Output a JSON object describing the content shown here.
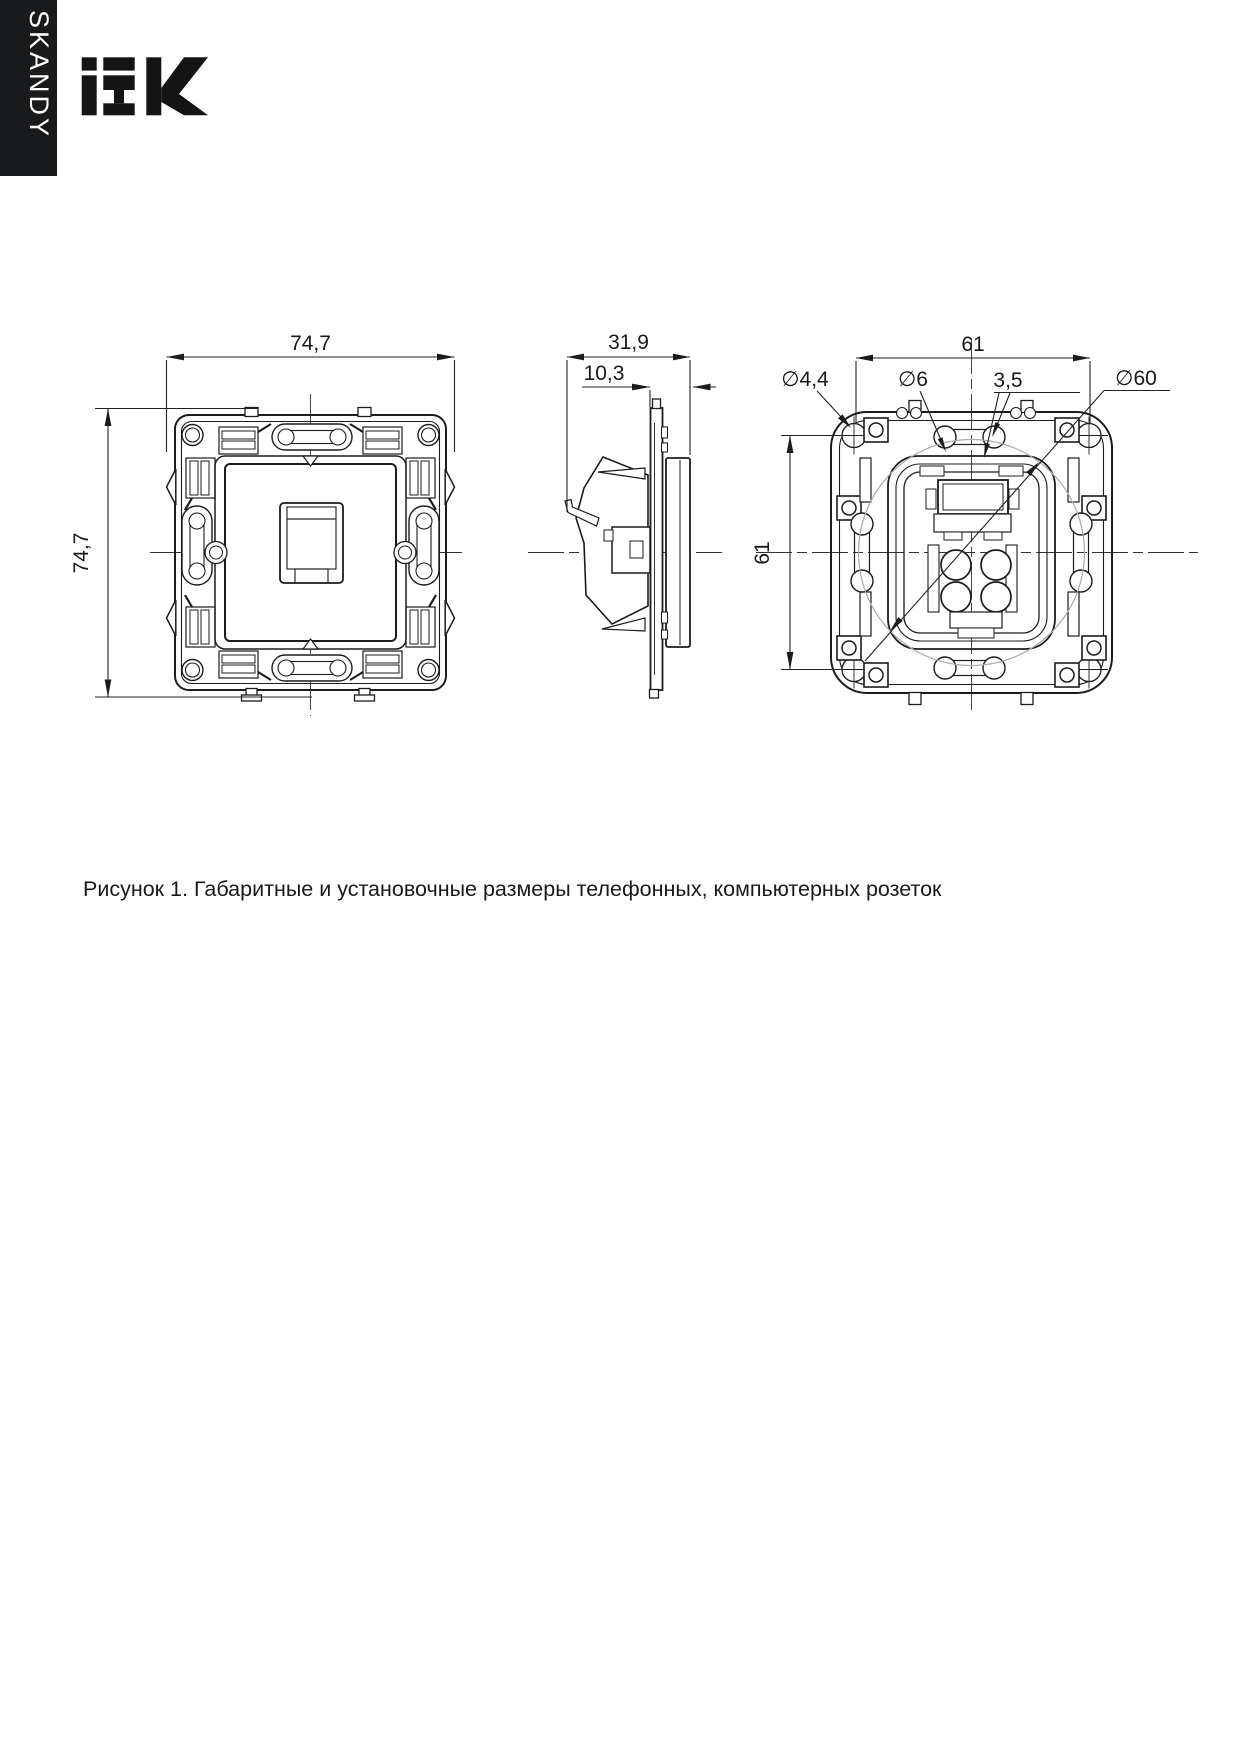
{
  "page": {
    "background": "#ffffff"
  },
  "sidebar_banner": {
    "series": "SKANDY"
  },
  "brand": {
    "name": "IEK"
  },
  "figure": {
    "caption": "Рисунок 1. Габаритные и установочные размеры телефонных, компьютерных розеток",
    "front_view": {
      "width": "74,7",
      "height": "74,7"
    },
    "side_view": {
      "depth": "31,9",
      "front_depth": "10,3"
    },
    "back_view": {
      "hole_spacing_h": "61",
      "hole_spacing_v": "61",
      "screw_hole_dia": "∅4,4",
      "slot_hole_dia": "∅6",
      "slot_width": "3,5",
      "mounting_dia": "∅60"
    }
  }
}
